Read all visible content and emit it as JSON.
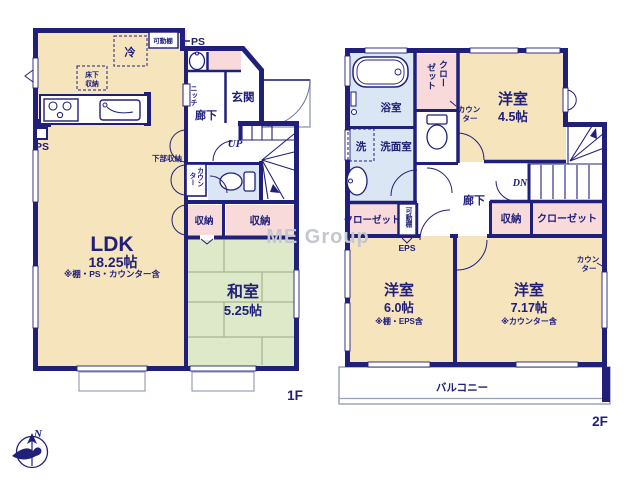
{
  "watermark": "ME Group",
  "colors": {
    "wall_navy": "#20207a",
    "room_beige": "#f6e4bd",
    "tatami_green": "#dde9c8",
    "closet_pink": "#f8dada",
    "wet_area_blue": "#dae6f3",
    "watermark_gray": "#c4c7d1"
  },
  "floor1": {
    "label": "1F",
    "ldk": {
      "name": "LDK",
      "size": "18.25帖",
      "note": "※棚・PS・カウンター含"
    },
    "washitsu": {
      "name": "和室",
      "size": "5.25帖"
    },
    "genkan": "玄関",
    "rouka": "廊下",
    "up": "UP",
    "niche": "ニッチ",
    "kadodana": "可動棚",
    "ps_top": "PS",
    "ps_left": "PS",
    "fridge": "冷",
    "yukashita": [
      "床下",
      "収納"
    ],
    "kabu_shuno": "下部収納",
    "counter": [
      "カウン",
      "ター"
    ],
    "shuno1": "収納",
    "shuno2": "収納"
  },
  "floor2": {
    "label": "2F",
    "yoshitsu_a": {
      "name": "洋室",
      "size": "4.5帖"
    },
    "yoshitsu_b": {
      "name": "洋室",
      "size": "6.0帖",
      "note": "※棚・EPS含"
    },
    "yoshitsu_c": {
      "name": "洋室",
      "size": "7.17帖",
      "note": "※カウンター含"
    },
    "yokushitsu": "浴室",
    "senmen": "洗面室",
    "sen": "洗",
    "closet_top": [
      "クロー",
      "ゼット"
    ],
    "counter_a": [
      "カウン",
      "ター"
    ],
    "rouka": "廊下",
    "dn": "DN",
    "closet_left": "クローゼット",
    "kadodana": "可動棚",
    "eps": "EPS",
    "shuno": "収納",
    "closet_right": "クローゼット",
    "counter_c": [
      "カウン",
      "ター"
    ],
    "balcony": "バルコニー"
  },
  "compass": {
    "north": "N"
  }
}
